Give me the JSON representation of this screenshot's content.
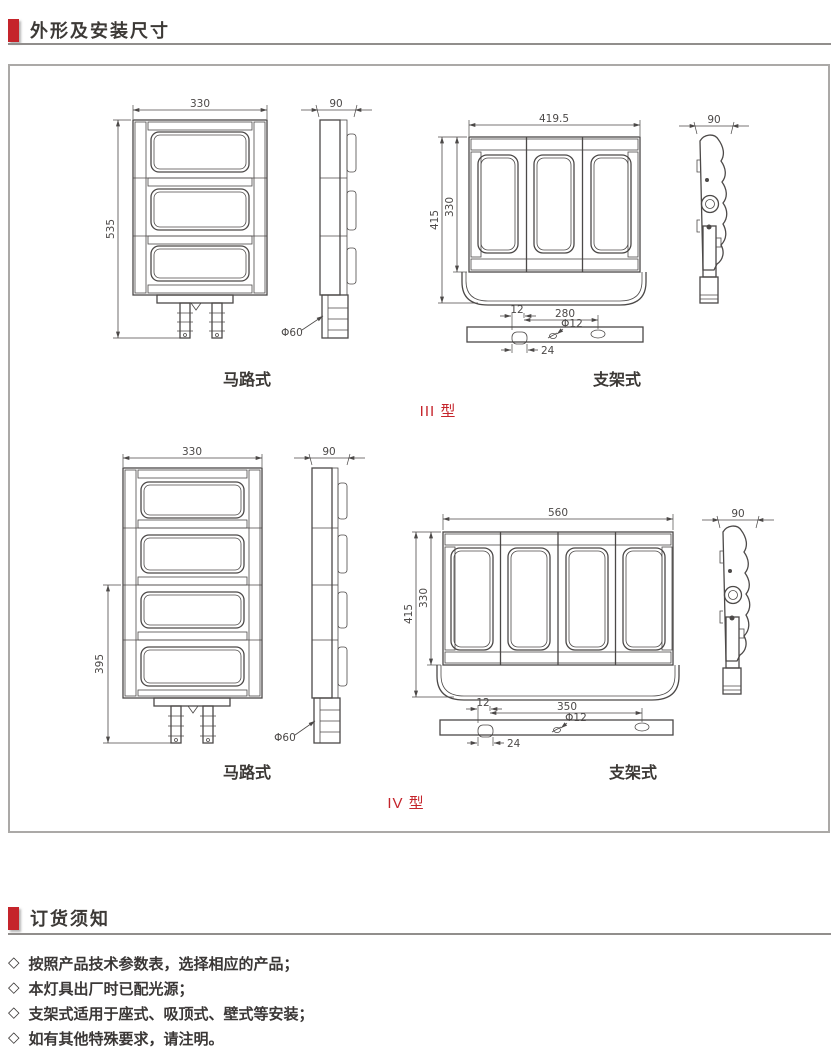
{
  "header": {
    "title": "外形及安装尺寸"
  },
  "type3": {
    "label": "III 型",
    "road": {
      "caption": "马路式",
      "front": {
        "width": "330",
        "height": "535"
      },
      "side": {
        "width": "90",
        "pole_dia": "Φ60"
      }
    },
    "bracket": {
      "caption": "支架式",
      "front": {
        "width": "419.5",
        "height_outer": "415",
        "height_inner": "330"
      },
      "side": {
        "width": "90"
      },
      "plate": {
        "offset": "12",
        "span": "280",
        "hole_dia": "Φ12",
        "slot": "24"
      }
    }
  },
  "type4": {
    "label": "IV 型",
    "road": {
      "caption": "马路式",
      "front": {
        "width": "330",
        "height": "395"
      },
      "side": {
        "width": "90",
        "pole_dia": "Φ60"
      }
    },
    "bracket": {
      "caption": "支架式",
      "front": {
        "width": "560",
        "height_outer": "415",
        "height_inner": "330"
      },
      "side": {
        "width": "90"
      },
      "plate": {
        "offset": "12",
        "span": "350",
        "hole_dia": "Φ12",
        "slot": "24"
      }
    }
  },
  "ordering": {
    "title": "订货须知",
    "bullet": "◇",
    "notes": [
      "按照产品技术参数表，选择相应的产品；",
      "本灯具出厂时已配光源；",
      "支架式适用于座式、吸顶式、壁式等安装；",
      "如有其他特殊要求，请注明。"
    ]
  },
  "colors": {
    "accent": "#c5242b",
    "line": "#4c4948",
    "border": "#aba9a7"
  }
}
